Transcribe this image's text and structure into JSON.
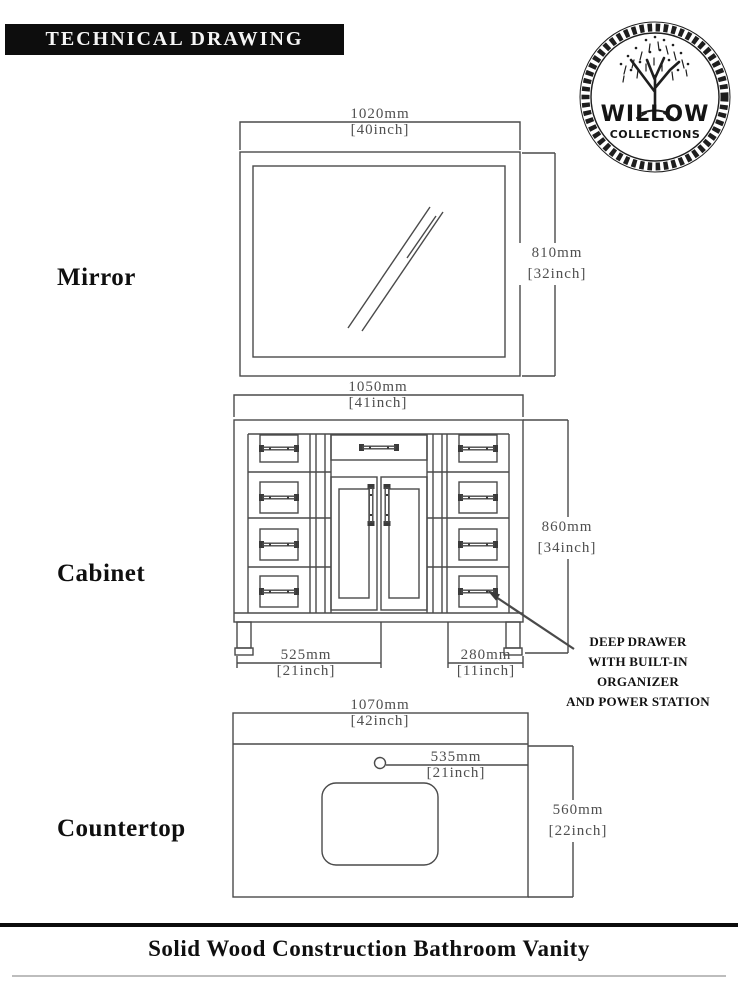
{
  "header": {
    "title": "TECHNICAL DRAWING"
  },
  "logo": {
    "brand": "WILLOW",
    "sub_brand": "COLLECTIONS"
  },
  "sections": {
    "mirror": {
      "label": "Mirror",
      "width_mm": "1020mm",
      "width_inch": "[40inch]",
      "height_mm": "810mm",
      "height_inch": "[32inch]"
    },
    "cabinet": {
      "label": "Cabinet",
      "width_mm": "1050mm",
      "width_inch": "[41inch]",
      "height_mm": "860mm",
      "height_inch": "[34inch]",
      "left_section_mm": "525mm",
      "left_section_inch": "[21inch]",
      "right_section_mm": "280mm",
      "right_section_inch": "[11inch]"
    },
    "countertop": {
      "label": "Countertop",
      "width_mm": "1070mm",
      "width_inch": "[42inch]",
      "faucet_offset_mm": "535mm",
      "faucet_offset_inch": "[21inch]",
      "depth_mm": "560mm",
      "depth_inch": "[22inch]"
    }
  },
  "callout": {
    "lines": [
      "DEEP DRAWER",
      "WITH BUILT-IN",
      "ORGANIZER",
      "AND POWER STATION"
    ]
  },
  "footer": {
    "title": "Solid Wood Construction Bathroom Vanity"
  },
  "colors": {
    "line": "#4a4a4a",
    "dim_text": "#4f4f4f",
    "header_bg": "#0d0d0d",
    "text": "#111111"
  }
}
